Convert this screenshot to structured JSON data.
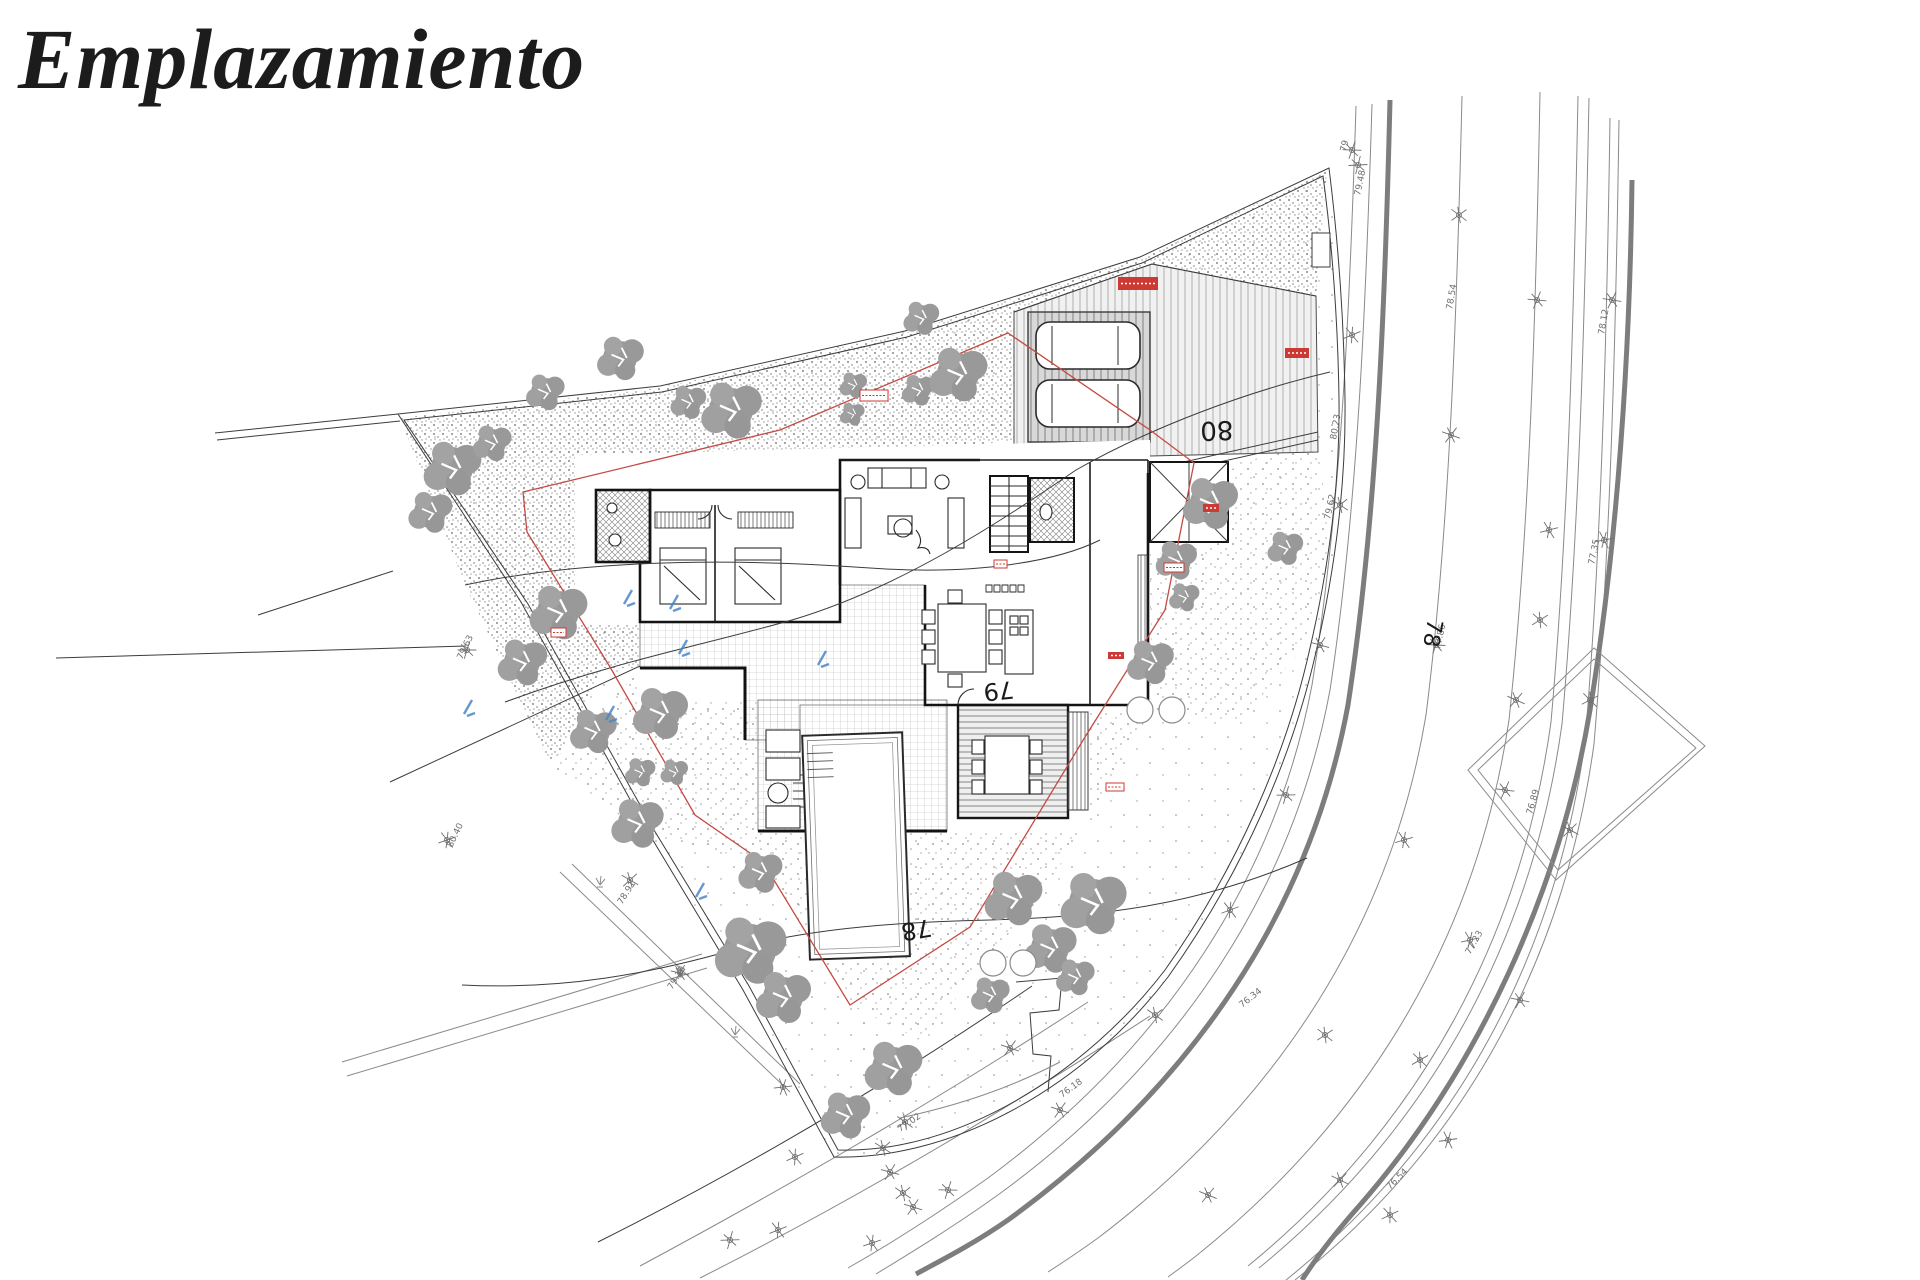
{
  "title": "Emplazamiento",
  "colors": {
    "ink": "#1a1a1a",
    "tree_gray": "#9b9b9b",
    "survey_gray": "#6f6f6f",
    "road_thick_gray": "#7d7d7d",
    "setback_red": "#c44a42",
    "badge_red": "#cc3b33",
    "mark_blue": "#4a86c8"
  },
  "plan": {
    "contour_labels": [
      {
        "text": "80",
        "x": 1233,
        "y": 421,
        "rot": 178,
        "size": 26
      },
      {
        "text": "79",
        "x": 1013,
        "y": 681,
        "rot": 174,
        "size": 24
      },
      {
        "text": "78",
        "x": 930,
        "y": 919,
        "rot": 170,
        "size": 24
      },
      {
        "text": "78",
        "x": 1428,
        "y": 618,
        "rot": 100,
        "size": 22
      }
    ],
    "micro_labels": [
      {
        "text": "79",
        "x": 1346,
        "y": 152,
        "rot": -78
      },
      {
        "text": "79.48",
        "x": 1360,
        "y": 196,
        "rot": -78
      },
      {
        "text": "80.23",
        "x": 1336,
        "y": 440,
        "rot": -80
      },
      {
        "text": "79.62",
        "x": 1330,
        "y": 520,
        "rot": -78
      },
      {
        "text": "78.54",
        "x": 1452,
        "y": 310,
        "rot": -80
      },
      {
        "text": "77.86",
        "x": 1440,
        "y": 650,
        "rot": -78
      },
      {
        "text": "78.12",
        "x": 1604,
        "y": 335,
        "rot": -80
      },
      {
        "text": "77.35",
        "x": 1594,
        "y": 565,
        "rot": -78
      },
      {
        "text": "76.89",
        "x": 1532,
        "y": 815,
        "rot": -74
      },
      {
        "text": "76.34",
        "x": 1242,
        "y": 1008,
        "rot": -38
      },
      {
        "text": "76.18",
        "x": 1062,
        "y": 1098,
        "rot": -36
      },
      {
        "text": "77.02",
        "x": 900,
        "y": 1132,
        "rot": -34
      },
      {
        "text": "78.91",
        "x": 622,
        "y": 905,
        "rot": -58
      },
      {
        "text": "79.15",
        "x": 672,
        "y": 990,
        "rot": -58
      },
      {
        "text": "80.40",
        "x": 452,
        "y": 848,
        "rot": -64
      },
      {
        "text": "79.63",
        "x": 462,
        "y": 660,
        "rot": -64
      },
      {
        "text": "76.54",
        "x": 1390,
        "y": 1190,
        "rot": -45
      },
      {
        "text": "77.23",
        "x": 1470,
        "y": 955,
        "rot": -60
      }
    ],
    "trees": [
      [
        452,
        468,
        2.1
      ],
      [
        492,
        443,
        1.4
      ],
      [
        430,
        512,
        1.6
      ],
      [
        545,
        392,
        1.4
      ],
      [
        620,
        358,
        1.7
      ],
      [
        688,
        402,
        1.3
      ],
      [
        731,
        410,
        2.2
      ],
      [
        558,
        612,
        2.1
      ],
      [
        522,
        662,
        1.8
      ],
      [
        853,
        385,
        1.0
      ],
      [
        852,
        414,
        0.9
      ],
      [
        918,
        390,
        1.2
      ],
      [
        921,
        318,
        1.3
      ],
      [
        958,
        374,
        2.1
      ],
      [
        593,
        731,
        1.7
      ],
      [
        660,
        713,
        2.0
      ],
      [
        640,
        772,
        1.1
      ],
      [
        674,
        772,
        1.0
      ],
      [
        637,
        823,
        1.9
      ],
      [
        1210,
        503,
        2.0
      ],
      [
        1176,
        560,
        1.5
      ],
      [
        1184,
        597,
        1.1
      ],
      [
        1285,
        548,
        1.3
      ],
      [
        1150,
        662,
        1.7
      ],
      [
        1013,
        898,
        2.1
      ],
      [
        1093,
        903,
        2.4
      ],
      [
        1050,
        948,
        1.9
      ],
      [
        1075,
        977,
        1.4
      ],
      [
        990,
        995,
        1.4
      ],
      [
        750,
        950,
        2.6
      ],
      [
        783,
        997,
        2.0
      ],
      [
        893,
        1068,
        2.1
      ],
      [
        845,
        1115,
        1.8
      ],
      [
        760,
        872,
        1.6
      ]
    ],
    "planters": [
      [
        993,
        963
      ],
      [
        1023,
        963
      ],
      [
        1140,
        710
      ],
      [
        1172,
        710
      ]
    ],
    "x_markers": [
      [
        1358,
        165
      ],
      [
        1352,
        335
      ],
      [
        1340,
        505
      ],
      [
        1320,
        645
      ],
      [
        1286,
        795
      ],
      [
        1230,
        910
      ],
      [
        1155,
        1015
      ],
      [
        1060,
        1110
      ],
      [
        948,
        1190
      ],
      [
        872,
        1243
      ],
      [
        1459,
        215
      ],
      [
        1451,
        435
      ],
      [
        1436,
        645
      ],
      [
        1404,
        840
      ],
      [
        1325,
        1035
      ],
      [
        1208,
        1195
      ],
      [
        1537,
        300
      ],
      [
        1549,
        530
      ],
      [
        1540,
        620
      ],
      [
        1516,
        700
      ],
      [
        1505,
        790
      ],
      [
        1470,
        940
      ],
      [
        1420,
        1060
      ],
      [
        1340,
        1180
      ],
      [
        1612,
        300
      ],
      [
        1604,
        540
      ],
      [
        1590,
        700
      ],
      [
        1570,
        830
      ],
      [
        1520,
        1000
      ],
      [
        1448,
        1140
      ],
      [
        1390,
        1215
      ],
      [
        630,
        880
      ],
      [
        680,
        973
      ],
      [
        783,
        1087
      ],
      [
        795,
        1157
      ],
      [
        883,
        1148
      ],
      [
        890,
        1172
      ],
      [
        730,
        1240
      ],
      [
        778,
        1230
      ],
      [
        903,
        1193
      ],
      [
        913,
        1207
      ],
      [
        467,
        650
      ],
      [
        447,
        840
      ],
      [
        905,
        1122
      ],
      [
        1010,
        1048
      ],
      [
        1352,
        150
      ]
    ],
    "blue_marks": [
      [
        628,
        597
      ],
      [
        674,
        602
      ],
      [
        683,
        647
      ],
      [
        610,
        713
      ],
      [
        468,
        707
      ],
      [
        822,
        658
      ],
      [
        700,
        890
      ]
    ],
    "badges_filled": [
      [
        1118,
        277,
        40,
        13
      ],
      [
        1285,
        348,
        24,
        10
      ],
      [
        1203,
        504,
        16,
        8
      ],
      [
        1108,
        652,
        16,
        7
      ]
    ],
    "badges_outline": [
      [
        860,
        390,
        28,
        11
      ],
      [
        551,
        628,
        15,
        9
      ],
      [
        994,
        560,
        13,
        8
      ],
      [
        1164,
        563,
        20,
        9
      ],
      [
        1106,
        783,
        18,
        8
      ]
    ]
  }
}
